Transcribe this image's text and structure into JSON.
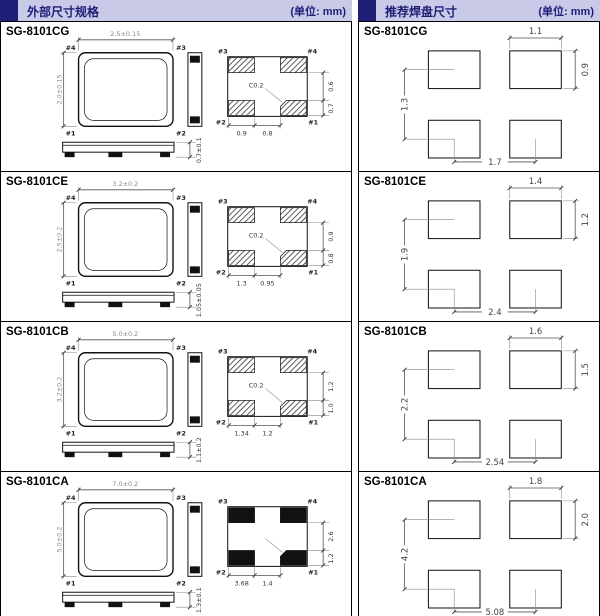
{
  "colors": {
    "header_bg": "#c9c9e8",
    "accent_navy": "#1f1f78",
    "line": "#000000"
  },
  "headers": {
    "left": {
      "title": "外部尺寸规格",
      "unit": "(单位: mm)"
    },
    "right": {
      "title": "推荐焊盘尺寸",
      "unit": "(单位: mm)"
    }
  },
  "models": [
    {
      "name": "SG-8101CG",
      "package": {
        "top_w": "2.5±0.15",
        "left_h": "2.0±0.15",
        "thickness": "0.7±0.1",
        "pins": {
          "tl": "#4",
          "tr": "#3",
          "bl": "#1",
          "br": "#2"
        }
      },
      "bottom": {
        "pins": {
          "tl": "#3",
          "tr": "#4",
          "bl": "#2",
          "br": "#1"
        },
        "right_top": "0.6",
        "right_bottom": "0.7",
        "bottom_left": "0.9",
        "bottom_right": "0.8",
        "chamfer": "C0.2",
        "pad_style": "hatch"
      },
      "land": {
        "pad_w": "1.1",
        "pad_h": "0.9",
        "v_pitch": "1.3",
        "h_pitch": "1.7"
      }
    },
    {
      "name": "SG-8101CE",
      "package": {
        "top_w": "3.2±0.2",
        "left_h": "2.5±0.2",
        "thickness": "1.05±0.05",
        "pins": {
          "tl": "#4",
          "tr": "#3",
          "bl": "#1",
          "br": "#2"
        }
      },
      "bottom": {
        "pins": {
          "tl": "#3",
          "tr": "#4",
          "bl": "#2",
          "br": "#1"
        },
        "right_top": "0.9",
        "right_bottom": "0.8",
        "bottom_left": "1.3",
        "bottom_right": "0.95",
        "chamfer": "C0.2",
        "pad_style": "hatch"
      },
      "land": {
        "pad_w": "1.4",
        "pad_h": "1.2",
        "v_pitch": "1.9",
        "h_pitch": "2.4"
      }
    },
    {
      "name": "SG-8101CB",
      "package": {
        "top_w": "5.0±0.2",
        "left_h": "3.2±0.2",
        "thickness": "1.1±0.2",
        "pins": {
          "tl": "#4",
          "tr": "#3",
          "bl": "#1",
          "br": "#2"
        }
      },
      "bottom": {
        "pins": {
          "tl": "#3",
          "tr": "#4",
          "bl": "#2",
          "br": "#1"
        },
        "right_top": "1.2",
        "right_bottom": "1.0",
        "bottom_left": "1.34",
        "bottom_right": "1.2",
        "chamfer": "C0.2",
        "pad_style": "hatch"
      },
      "land": {
        "pad_w": "1.6",
        "pad_h": "1.5",
        "v_pitch": "2.2",
        "h_pitch": "2.54"
      }
    },
    {
      "name": "SG-8101CA",
      "package": {
        "top_w": "7.0±0.2",
        "left_h": "5.0±0.2",
        "thickness": "1.3±0.1",
        "pins": {
          "tl": "#4",
          "tr": "#3",
          "bl": "#1",
          "br": "#2"
        }
      },
      "bottom": {
        "pins": {
          "tl": "#3",
          "tr": "#4",
          "bl": "#2",
          "br": "#1"
        },
        "right_top": "2.6",
        "right_bottom": "1.2",
        "bottom_left": "3.68",
        "bottom_right": "1.4",
        "chamfer": "",
        "pad_style": "solid"
      },
      "land": {
        "pad_w": "1.8",
        "pad_h": "2.0",
        "v_pitch": "4.2",
        "h_pitch": "5.08"
      }
    }
  ]
}
